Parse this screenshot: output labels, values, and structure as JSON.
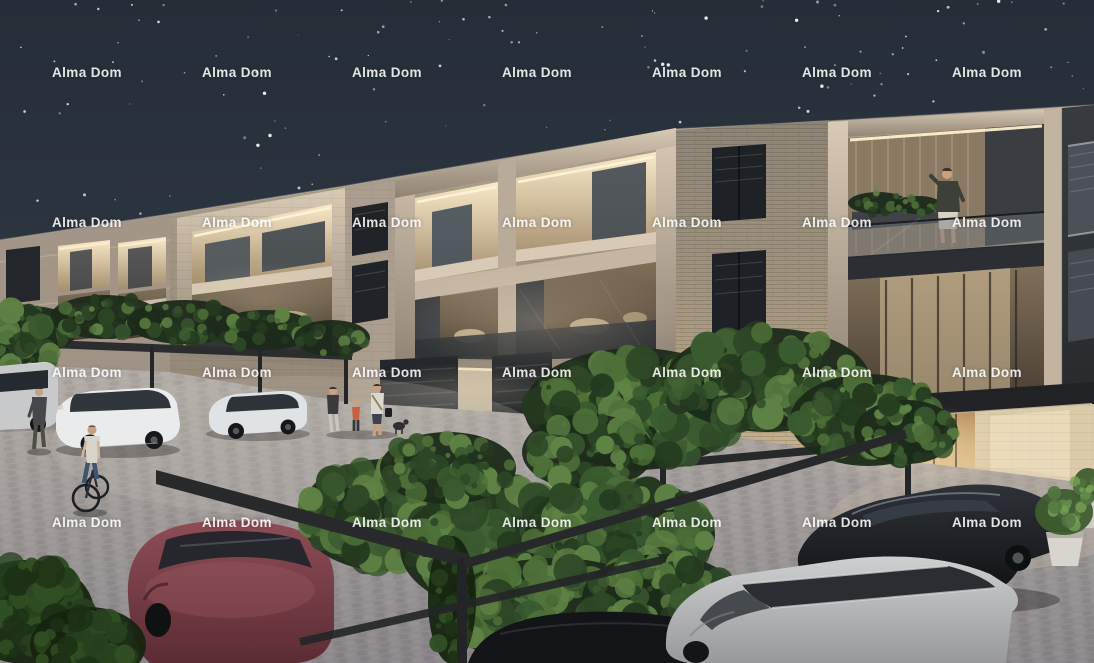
{
  "image": {
    "kind": "night architectural exterior rendering",
    "subject": "Three-storey residential apartment building with illuminated recessed balconies, vine-covered carport pergolas, parked cars, a cyclist and pedestrians at night"
  },
  "watermark": {
    "text": "Alma Dom",
    "color": "#ffffff",
    "opacity": 0.88,
    "grid": {
      "columns": 7,
      "rows": 4,
      "x_start": 52,
      "x_step": 150,
      "y_start": 74,
      "y_step": 150
    }
  },
  "colors": {
    "sky_top": "#252e38",
    "sky_horizon": "#36414c",
    "star": "#e9eff5",
    "stone_light": "#d8cab5",
    "stone_mid": "#b2a492",
    "stone_dark": "#8f8273",
    "brick_wall": "#9a9082",
    "charcoal": "#2e3134",
    "window_glass": "#1f2226",
    "warm_light": "#ffeecb",
    "interior_glow": "#e8d5b0",
    "pavement_light": "#b3aca6",
    "pavement_dark": "#8b878a",
    "foliage_dark": "#24391f",
    "foliage_mid": "#3c5a31",
    "foliage_light": "#5d7f46",
    "pergola_beam": "#26282a",
    "car_white": "#e9ebed",
    "car_maroon": "#74353d",
    "car_black": "#17191d",
    "car_silver": "#b5b7ba"
  }
}
